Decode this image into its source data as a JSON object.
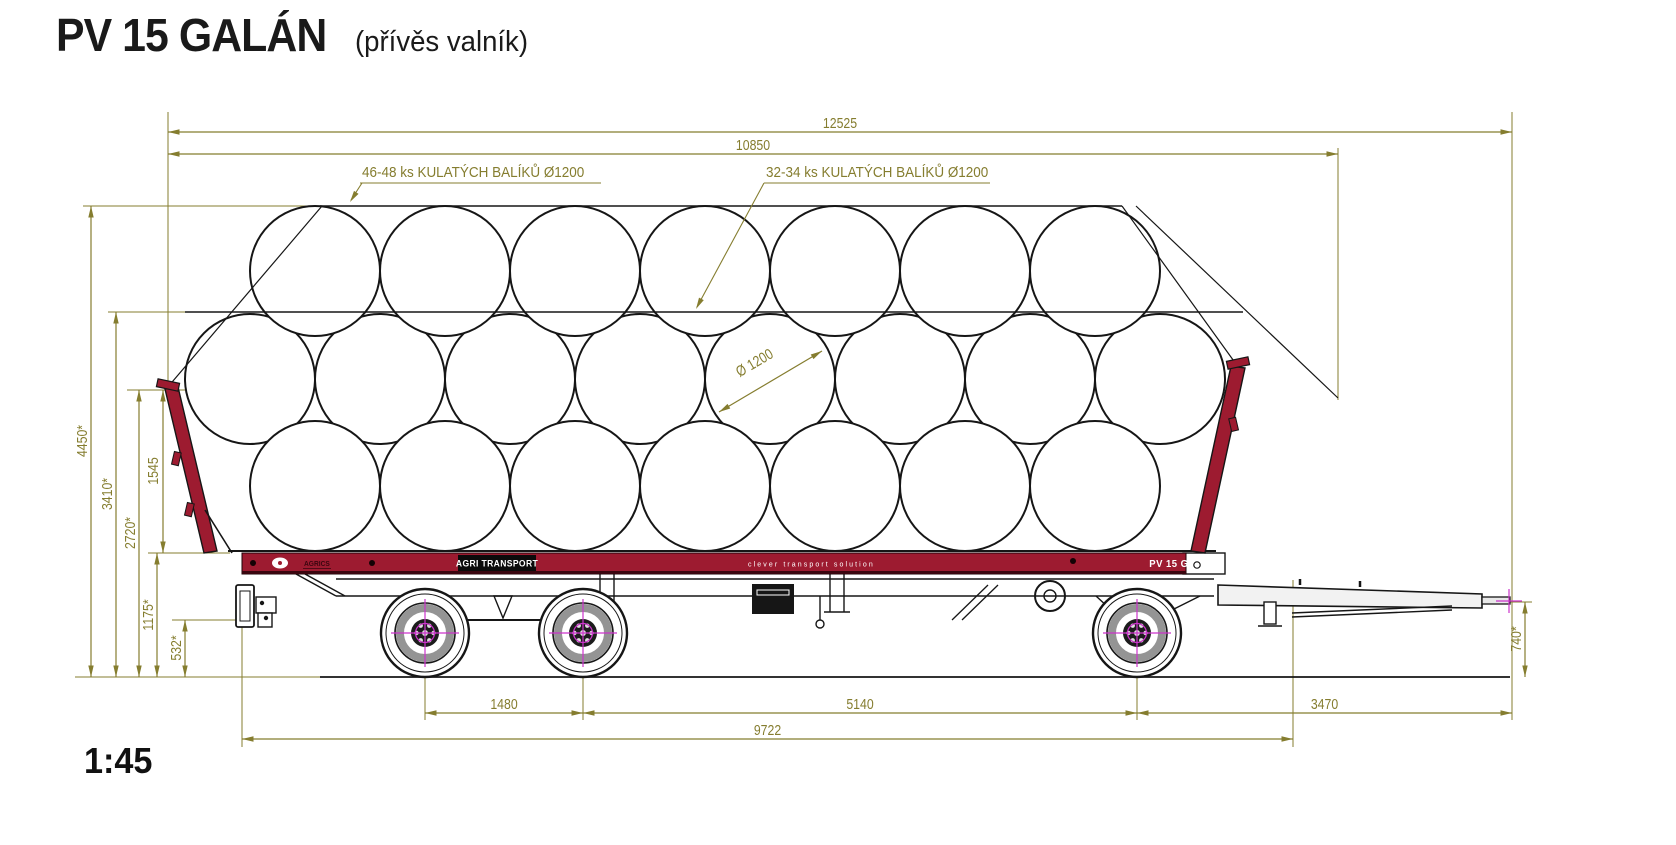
{
  "title": "PV 15 GALÁN",
  "subtitle": "(přívěs valník)",
  "scale_label": "1:45",
  "annotations": {
    "top_load_label": "46-48 ks  KULATÝCH BALÍKŮ Ø1200",
    "mid_load_label": "32-34 ks KULATÝCH BALÍKŮ Ø1200",
    "bale_diameter_label": "Ø 1200"
  },
  "dimensions": {
    "overall_length": "12525",
    "bed_length": "10850",
    "overall_height": "4450*",
    "two_row_height": "3410*",
    "side_height": "2720*",
    "wall_height": "1545",
    "platform_height": "1175*",
    "rear_clearance": "532*",
    "drawbar_eye_height": "740*",
    "tandem_axle_spacing": "1480",
    "axle_distance": "5140",
    "drawbar_length": "3470",
    "chassis_length": "9722"
  },
  "frame_branding": {
    "logo": "AGRICS",
    "plate": "AGRI TRANSPORT",
    "slogan": "clever transport solution",
    "model_plate": "PV 15 GALÁN"
  },
  "load": {
    "top_row_bales": 7,
    "middle_row_bales": 8,
    "bottom_row_bales": 7,
    "bale_diameter_mm": 1200
  },
  "colors": {
    "dimension": "#857d2f",
    "line": "#161616",
    "frame_red": "#9d1b30",
    "frame_red_dark": "#3a060f",
    "hub_magenta": "#cc33cc",
    "white": "#ffffff"
  }
}
